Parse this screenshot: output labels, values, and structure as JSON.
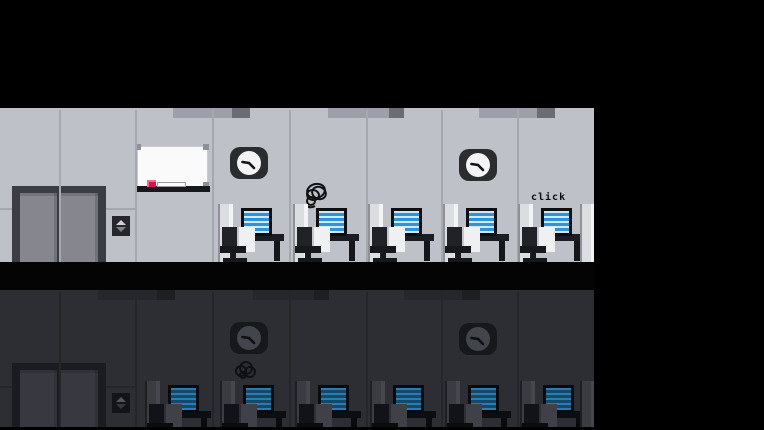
{
  "scene": {
    "sound_effect_text": "click",
    "floors": [
      {
        "id": "upper",
        "lit": true,
        "workstations": 5,
        "clocks": 2,
        "has_elevator": true,
        "has_whiteboard": true,
        "character": "scribble-ball"
      },
      {
        "id": "lower",
        "lit": false,
        "workstations": 6,
        "clocks": 2,
        "has_elevator": true,
        "has_whiteboard": false,
        "character": "scribble-ball"
      }
    ]
  },
  "palette": {
    "background_black": "#000000",
    "wall_light": "#bfc1c9",
    "wall_dark": "#2d2e33",
    "floor_slab": "#040405",
    "cubicle_white": "#eef0f2",
    "screen_blue": "#2f93da",
    "screen_stripe_blue": "#cfe9fa",
    "marker_red": "#d6134d"
  }
}
